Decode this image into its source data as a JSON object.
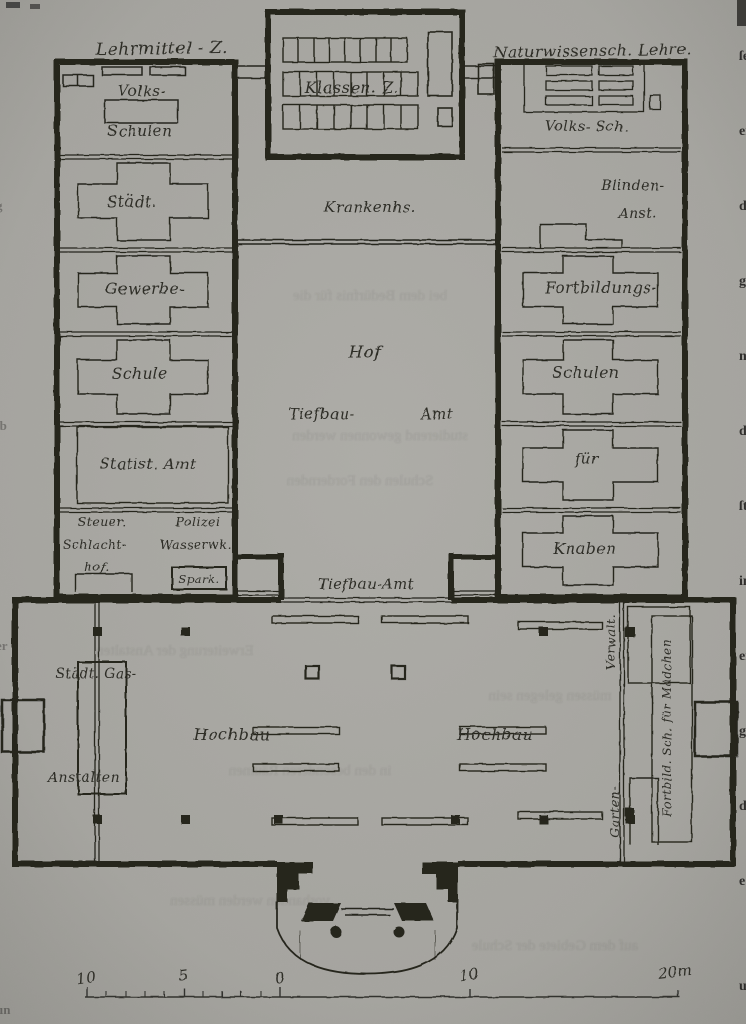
{
  "plan": {
    "headers": {
      "top_left": "Lehrmittel - Z.",
      "top_right": "Naturwissensch. Lehre."
    },
    "labels": {
      "klassen": "Klassen. Z.",
      "volks_left_1": "Volks-",
      "volks_left_2": "Schulen",
      "volks_right": "Volks- Sch.",
      "staedt": "Städt.",
      "krankenhaus": "Krankenhs.",
      "blinden_1": "Blinden-",
      "blinden_2": "Anst.",
      "gewerbe": "Gewerbe-",
      "schule": "Schule",
      "fortbildungs": "Fortbildungs-",
      "schulen": "Schulen",
      "statist_amt": "Statist. Amt",
      "fuer": "für",
      "knaben": "Knaben",
      "steuer": "Steuer.",
      "schlacht": "Schlacht-",
      "hof_suffix": "hof.",
      "polizei": "Polizei",
      "wasserwerk": "Wasserwk.",
      "sparkasse": "Spark.",
      "hof": "Hof",
      "tiefbau_1": "Tiefbau-",
      "tiefbau_2": "Amt",
      "tiefbau_amt": "Tiefbau-Amt",
      "staedt_gas": "Städt. Gas-",
      "anstalten": "Anstalten",
      "hochbau_left": "Hochbau",
      "hochbau_right": "Hochbau",
      "verwalt": "Verwalt.",
      "fortbild_maedchen": "Fortbild. Sch. für Mädchen",
      "garten": "Garten-"
    },
    "scale_labels": [
      "10",
      "5",
      "0",
      "10",
      "20m"
    ]
  },
  "artifacts": {
    "ghost_text": [
      "bei dem Bedürfnis für die",
      "studierend gewonnen werden",
      "Schulen den Fordernden",
      "Erweiterung der Anstalten",
      "müssen gelegen sein",
      "in den besonderen Räumen",
      "vorhanden werden müssen",
      "auf dem Gebiete der Schule"
    ],
    "edge_right": [
      "ſe",
      "er",
      "d.",
      "ge",
      "n",
      "die",
      "ſt",
      "in",
      "er",
      "g.",
      "den",
      "e",
      "ung"
    ],
    "edge_left": [
      "g",
      "ib",
      "er",
      "un"
    ]
  }
}
